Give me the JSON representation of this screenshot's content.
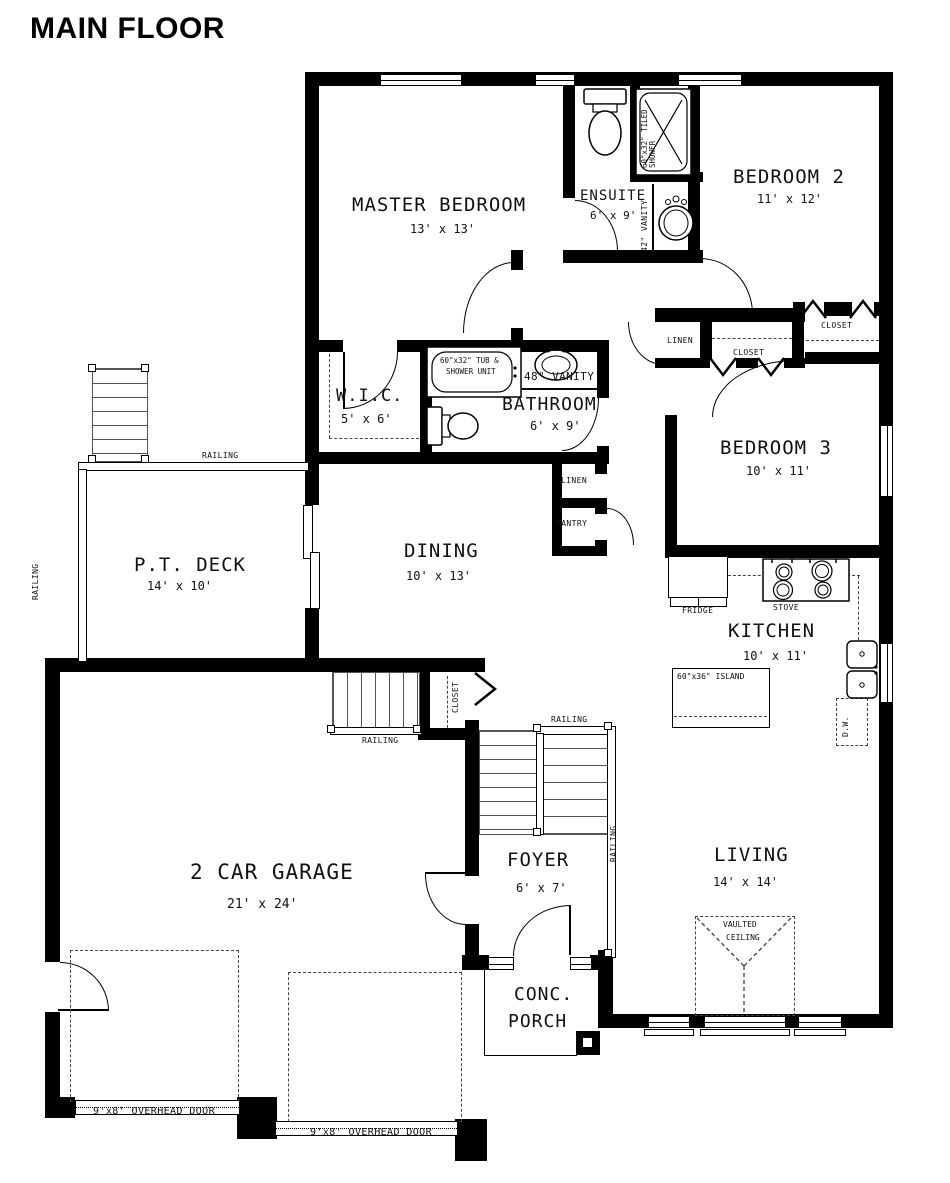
{
  "title": "MAIN FLOOR",
  "rooms": {
    "master": {
      "name": "MASTER BEDROOM",
      "dims": "13' x 13'"
    },
    "ensuite": {
      "name": "ENSUITE",
      "dims": "6' x 9'"
    },
    "bedroom2": {
      "name": "BEDROOM 2",
      "dims": "11' x 12'"
    },
    "wic": {
      "name": "W.I.C.",
      "dims": "5' x 6'"
    },
    "bathroom": {
      "name": "BATHROOM",
      "dims": "6' x 9'"
    },
    "bedroom3": {
      "name": "BEDROOM 3",
      "dims": "10' x 11'"
    },
    "deck": {
      "name": "P.T. DECK",
      "dims": "14' x 10'"
    },
    "dining": {
      "name": "DINING",
      "dims": "10' x 13'"
    },
    "kitchen": {
      "name": "KITCHEN",
      "dims": "10' x 11'"
    },
    "garage": {
      "name": "2 CAR GARAGE",
      "dims": "21' x 24'"
    },
    "foyer": {
      "name": "FOYER",
      "dims": "6' x 7'"
    },
    "living": {
      "name": "LIVING",
      "dims": "14' x 14'"
    },
    "porch": {
      "line1": "CONC.",
      "line2": "PORCH"
    }
  },
  "fixtures": {
    "tiled_shower_line1": "60\"x32\" TILED",
    "tiled_shower_line2": "SHOWER",
    "vanity_42": "42\" VANITY",
    "tub_line1": "60\"x32\" TUB &",
    "tub_line2": "SHOWER UNIT",
    "vanity_48": "48\" VANITY",
    "fridge": "FRIDGE",
    "stove": "STOVE",
    "island": "60\"x36\" ISLAND",
    "dishwasher": "D.W."
  },
  "storage": {
    "linen": "LINEN",
    "closet": "CLOSET",
    "pantry": "PANTRY"
  },
  "annotations": {
    "railing": "RAILING",
    "vaulted_line1": "VAULTED",
    "vaulted_line2": "CEILING",
    "overhead_door": "9'x8' OVERHEAD DOOR"
  }
}
